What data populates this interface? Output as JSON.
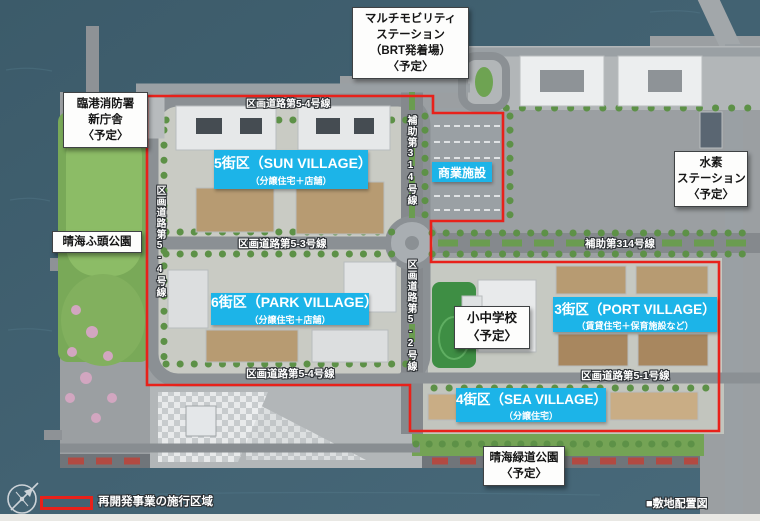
{
  "map": {
    "caption": "■敷地配置図",
    "legend_label": "再開発事業の施行区域",
    "facilities": [
      {
        "id": "multi-mobility-station",
        "lines": [
          "マルチモビリティ",
          "ステーション",
          "（BRT発着場）",
          "〈予定〉"
        ]
      },
      {
        "id": "rinko-fire-station-new-building",
        "lines": [
          "臨港消防署",
          "新庁舎",
          "〈予定〉"
        ]
      },
      {
        "id": "hydrogen-station",
        "lines": [
          "水素",
          "ステーション",
          "〈予定〉"
        ]
      },
      {
        "id": "harumi-wharf-park",
        "lines": [
          "晴海ふ頭公園"
        ]
      },
      {
        "id": "elementary-junior-high-school",
        "lines": [
          "小中学校",
          "〈予定〉"
        ]
      },
      {
        "id": "harumi-green-road-park",
        "lines": [
          "晴海緑道公園",
          "〈予定〉"
        ]
      }
    ],
    "districts": [
      {
        "id": "block-5-sun-village",
        "name": "5街区（SUN VILLAGE）",
        "use": "（分譲住宅＋店舗）"
      },
      {
        "id": "commercial-facility",
        "name": "商業施設",
        "use": ""
      },
      {
        "id": "block-6-park-village",
        "name": "6街区（PARK VILLAGE）",
        "use": "（分譲住宅＋店舗）"
      },
      {
        "id": "block-3-port-village",
        "name": "3街区（PORT VILLAGE）",
        "use": "（賃貸住宅＋保育施設など）"
      },
      {
        "id": "block-4-sea-village",
        "name": "4街区（SEA VILLAGE）",
        "use": "（分譲住宅）"
      }
    ],
    "roads": [
      {
        "id": "kukaku-5-4-north",
        "label": "区画道路第5-4号線",
        "orientation": "horizontal"
      },
      {
        "id": "hojo-314-center",
        "label": "補助第314号線",
        "orientation": "vertical"
      },
      {
        "id": "kukaku-5-3",
        "label": "区画道路第5-3号線",
        "orientation": "horizontal"
      },
      {
        "id": "hojo-314-east",
        "label": "補助第314号線",
        "orientation": "horizontal"
      },
      {
        "id": "kukaku-5-4-west",
        "label": "区画道路第5-4号線",
        "orientation": "vertical"
      },
      {
        "id": "kukaku-5-2",
        "label": "区画道路第5-2号線",
        "orientation": "vertical"
      },
      {
        "id": "kukaku-5-4-south",
        "label": "区画道路第5-4号線",
        "orientation": "horizontal"
      },
      {
        "id": "kukaku-5-1",
        "label": "区画道路第5-1号線",
        "orientation": "horizontal"
      }
    ],
    "colors": {
      "boundary_red": "#e8211a",
      "district_label_bg": "#1cb4e8",
      "water": "#40606e",
      "land": "#9b9fa2",
      "park_green": "#7fae5c"
    }
  }
}
